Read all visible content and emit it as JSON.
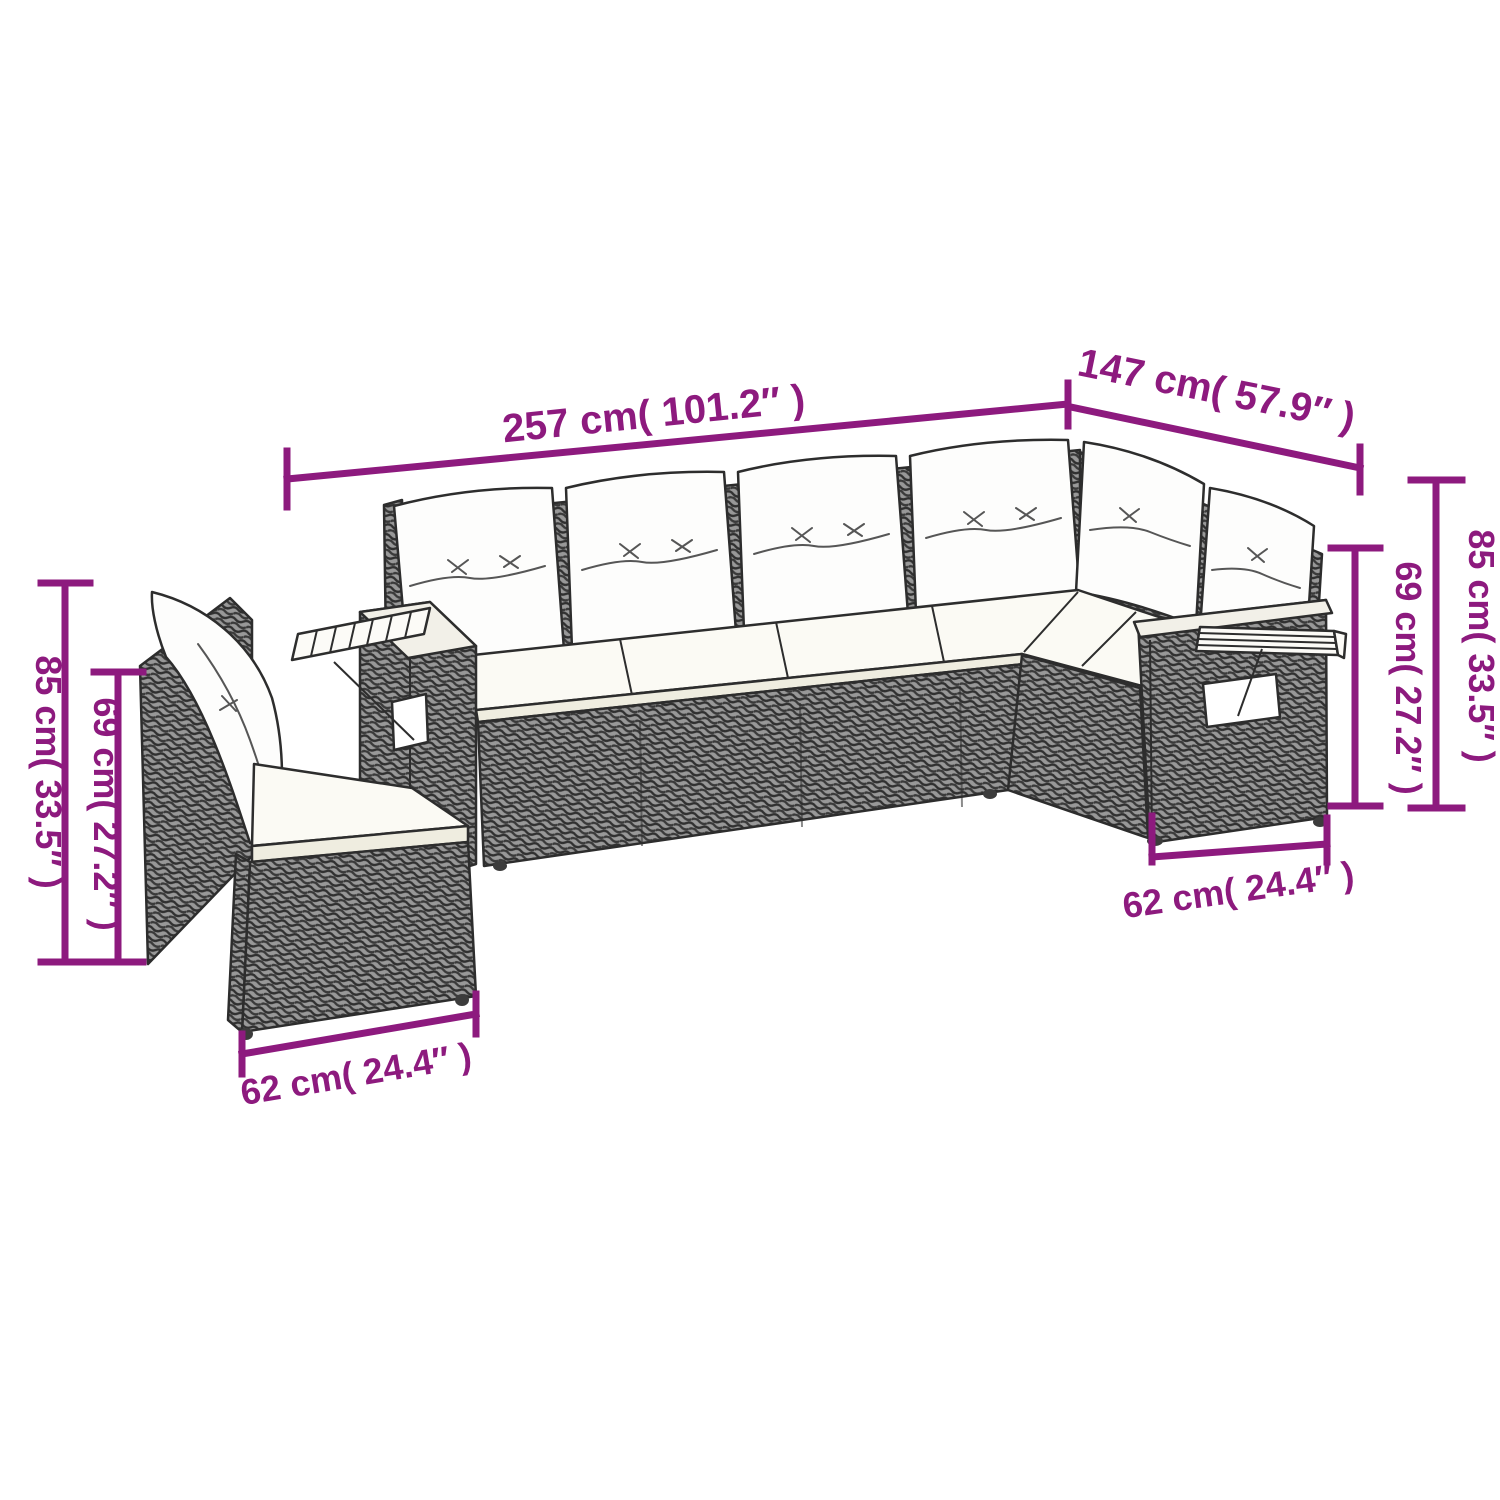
{
  "diagram": {
    "type": "product-dimension-diagram",
    "subject": "L-shaped rattan garden sofa set with cushions and fold-out wooden shelves",
    "accent_color": "#8d1a7e",
    "annotations": {
      "total_length": "257 cm( 101.2″ )",
      "total_depth": "147 cm( 57.9″ )",
      "left_total_height": "85 cm( 33.5″ )",
      "left_back_height": "69 cm( 27.2″ )",
      "right_back_height": "69 cm( 27.2″ )",
      "right_total_height": "85 cm( 33.5″ )",
      "left_module_width": "62 cm( 24.4″ )",
      "right_module_width": "62 cm( 24.4″ )"
    }
  }
}
